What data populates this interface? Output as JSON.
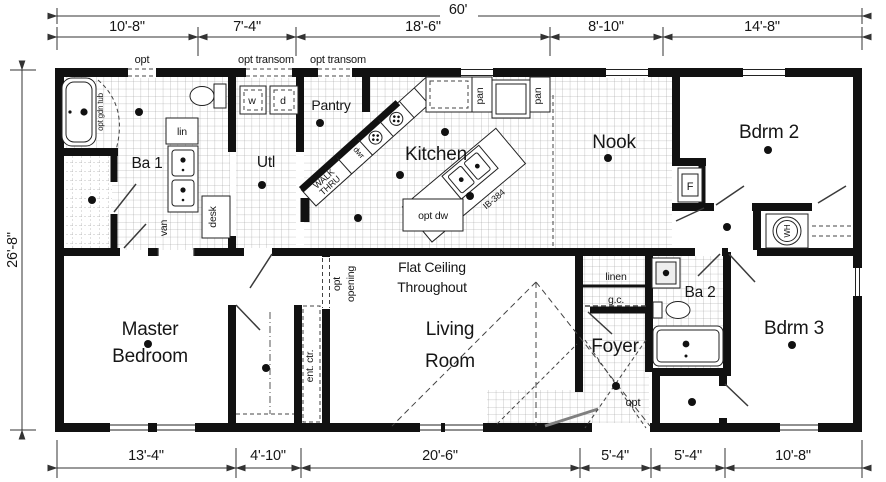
{
  "plan": {
    "dimensions": {
      "overall_width": "60'",
      "overall_depth": "26'-8\"",
      "top_segments": [
        "10'-8\"",
        "7'-4\"",
        "18'-6\"",
        "8'-10\"",
        "14'-8\""
      ],
      "bottom_segments": [
        "13'-4\"",
        "4'-10\"",
        "20'-6\"",
        "5'-4\"",
        "5'-4\"",
        "10'-8\""
      ]
    },
    "rooms": {
      "ba1": "Ba 1",
      "utl": "Utl",
      "pantry": "Pantry",
      "kitchen": "Kitchen",
      "nook": "Nook",
      "bdrm2": "Bdrm 2",
      "master": [
        "Master",
        "Bedroom"
      ],
      "living": [
        "Living",
        "Room"
      ],
      "foyer": "Foyer",
      "ba2": "Ba 2",
      "bdrm3": "Bdrm 3"
    },
    "notes": {
      "flat_ceiling": [
        "Flat Ceiling",
        "Throughout"
      ],
      "opt_opening": [
        "opt",
        "opening"
      ],
      "walk_thru": [
        "WALK",
        "THRU"
      ]
    },
    "labels": {
      "opt_window": "opt",
      "opt_transom_a": "opt transom",
      "opt_transom_b": "opt transom",
      "opt_gdn_tub": "opt gdn tub",
      "lin": "lin",
      "van": "van",
      "desk": "desk",
      "washer": "w",
      "dryer": "d",
      "dwr": "dwr",
      "pan_a": "pan",
      "pan_b": "pan",
      "opt_dw": "opt dw",
      "island_model": "IB-384",
      "furnace": "F",
      "water_heater": "WH",
      "ent_ctr": "ent. ctr.",
      "linen": "linen",
      "gc": "g.c.",
      "opt_foyer": "opt"
    }
  }
}
